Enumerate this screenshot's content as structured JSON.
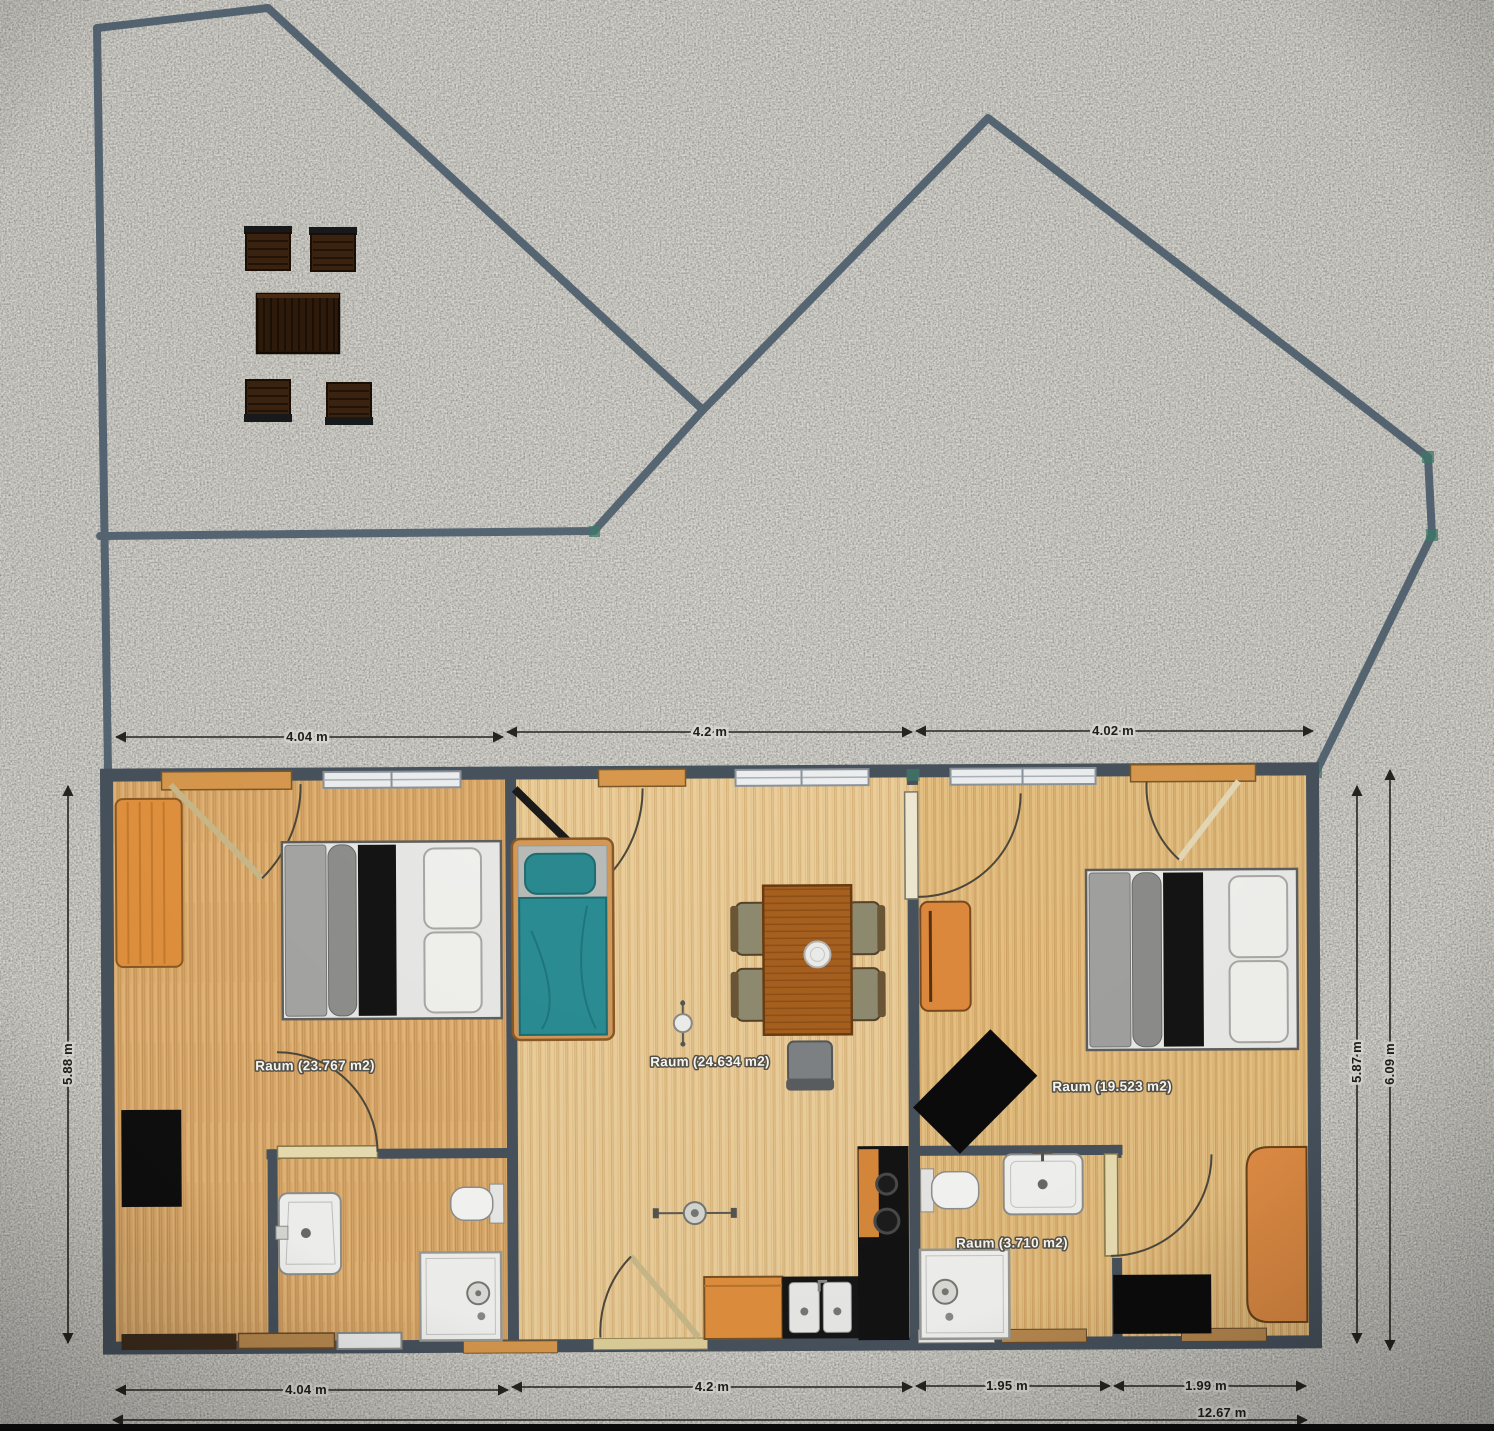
{
  "scene": {
    "type": "floor-plan-with-site-plan",
    "description": "Top-down floor plan of a three-room dwelling with two bathrooms, site boundary fence on gravel ground, and a garden furniture set (table with four chairs)"
  },
  "colors": {
    "gravel_base": "#96948e",
    "boundary_line": "#4e5f6d",
    "wall": "#47525d",
    "floor_left": "#ddad6e",
    "floor_middle": "#eccf9b",
    "floor_right": "#e6c285",
    "furniture_orange": "#e0923f",
    "bed_teal": "#2a8a90",
    "table_brown": "#a7601f",
    "outdoor_wood": "#2e1a0b",
    "dimension_text": "#1e1e1a",
    "room_label_text": "#fbfaf4"
  },
  "rooms": [
    {
      "id": "room-left",
      "label": "Raum (23.767 m2)",
      "area_m2": 23.767
    },
    {
      "id": "room-middle",
      "label": "Raum (24.634 m2)",
      "area_m2": 24.634
    },
    {
      "id": "room-right",
      "label": "Raum (19.523 m2)",
      "area_m2": 19.523
    },
    {
      "id": "room-bathroom",
      "label": "Raum (3.710 m2)",
      "area_m2": 3.71
    }
  ],
  "dimensions": {
    "top": [
      {
        "label": "4.04 m"
      },
      {
        "label": "4.2 m"
      },
      {
        "label": "4.02 m"
      }
    ],
    "bottom": [
      {
        "label": "4.04 m"
      },
      {
        "label": "4.2 m"
      },
      {
        "label": "1.95 m"
      },
      {
        "label": "1.99 m"
      }
    ],
    "total_width": {
      "label": "12.67 m"
    },
    "left_height": {
      "label": "5.88 m"
    },
    "right_height_inner": {
      "label": "5.87 m"
    },
    "right_height_outer": {
      "label": "6.09 m"
    }
  },
  "furniture": {
    "garden": [
      "patio table",
      "patio chair",
      "patio chair",
      "patio chair",
      "patio chair"
    ],
    "room_left": [
      "wardrobe",
      "double bed",
      "black cabinet",
      "washbasin",
      "toilet",
      "shower"
    ],
    "room_middle": [
      "single bed (teal)",
      "dining table with plate",
      "4 dining chairs",
      "desk chair",
      "ceiling lamp",
      "ceiling lamp",
      "kitchen cabinet",
      "double kitchen sink",
      "cooktop counter"
    ],
    "room_right": [
      "cabinet",
      "double bed",
      "tv (rotated)",
      "black rug",
      "desk",
      "washbasin",
      "toilet",
      "shower"
    ]
  }
}
